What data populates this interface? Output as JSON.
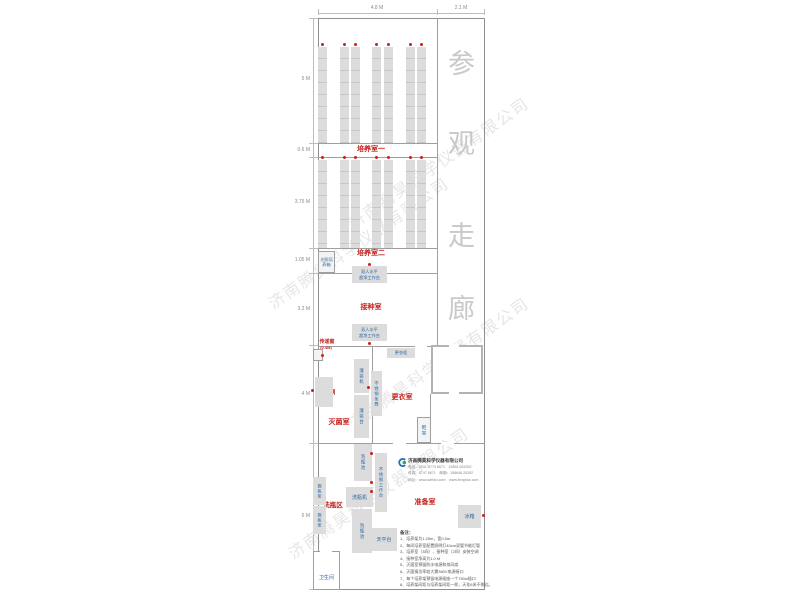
{
  "watermark": "济南腾昊科学仪器有限公司",
  "corridor": {
    "c0": "参",
    "c1": "观",
    "c2": "走",
    "c3": "廊"
  },
  "dims": {
    "top_w1": "4.8 M",
    "top_w2": "2.1 M",
    "left_h1": "5 M",
    "left_h2": "0.6 M",
    "left_h3": "3.75 M",
    "left_h4": "1.05 M",
    "left_h5": "3.2 M",
    "left_h6": "4 M",
    "left_h7": "6 M"
  },
  "rooms": {
    "culture1": "培养室一",
    "culture2": "培养室二",
    "inoculation": "接种室",
    "passbox": "传递窗",
    "passbox_size": "(0.4M)",
    "autoclave": "灭菌锅",
    "sterilization": "灭菌室",
    "changing": "更衣室",
    "buffer": "缓冲间",
    "washing_area": "洗瓶区",
    "preparation": "准备室"
  },
  "equipment": {
    "light_incubator": "光照培养箱",
    "bench_line1": "双人水平",
    "bench_line2": "超净工作台",
    "locker": "更衣柜",
    "filling_machine": "灌装机",
    "steel_bench": "不锈钢条凳",
    "filling_table": "灌装台",
    "shoe_rack": "鞋架",
    "soak_pool1": "泡瓶池",
    "steel_worktable": "不锈钢工作台",
    "bottle_washer": "洗瓶机",
    "soak_pool2": "泡瓶池",
    "balance_table": "天平台",
    "bottle_shelf1": "搁瓶架",
    "bottle_shelf2": "搁瓶架",
    "fridge": "冰箱",
    "toilet": "卫生间"
  },
  "company": {
    "name": "济南腾昊科学仪器有限公司",
    "line1": "电话：0531-8779 6671　15864 625392",
    "line2": "传真：8747 6671　邮箱：158646 25392",
    "line3": "网址：www.sdthkx.com　www.tenghao.com"
  },
  "notes": {
    "title": "备注：",
    "n1": "1、培养架为1.25m，宽0.5m",
    "n2": "2、每间培养室配置照明灯40cm双管节能灯管",
    "n3": "3、培养室（3间）、接种室（2间）安装空调",
    "n4": "4、接种室净高为1.0 M",
    "n5": "5、灭菌室预留防水电源和排风扇",
    "n6": "6、灭菌锅功率较大需380V电源接口",
    "n7": "7、每个培养架预留电源插座一个750w插口",
    "n8": "8、培养架间距与培养架间距一样，天花6米不倒边。"
  }
}
